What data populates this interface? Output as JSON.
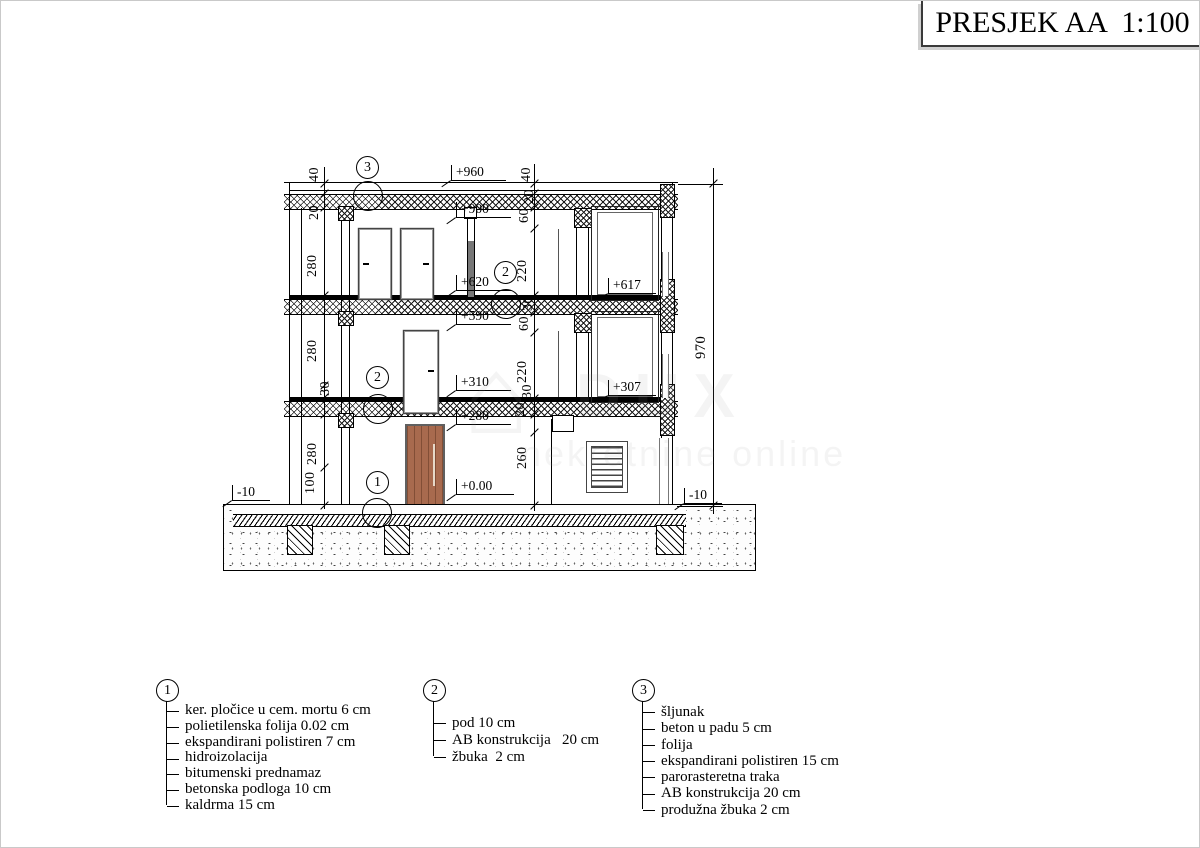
{
  "title": "PRESJEK AA  1:100",
  "watermark": {
    "house_glyph": "⌂",
    "brand": "DUX",
    "sub": "nekretnine online"
  },
  "dims": {
    "left": [
      "40",
      "20",
      "280",
      "280",
      "30",
      "280",
      "100"
    ],
    "center": [
      "40",
      "20",
      "60",
      "220",
      "30",
      "60",
      "220",
      "30",
      "20",
      "260"
    ],
    "overall": "970"
  },
  "elevations": [
    "+960",
    "+900",
    "+620",
    "+590",
    "+310",
    "+280",
    "+0.00",
    "+617",
    "+307",
    "-10",
    "-10"
  ],
  "callouts": [
    "3",
    "2",
    "2",
    "1"
  ],
  "legends": [
    {
      "num": "1",
      "items": [
        "ker. pločice u cem. mortu 6 cm",
        "polietilenska folija 0.02 cm",
        "ekspandirani polistiren 7 cm",
        "hidroizolacija",
        "bitumenski prednamaz",
        "betonska podloga 10 cm",
        "kaldrma 15 cm"
      ]
    },
    {
      "num": "2",
      "items": [
        "pod 10 cm",
        "AB konstrukcija   20 cm",
        "žbuka  2 cm"
      ]
    },
    {
      "num": "3",
      "items": [
        "šljunak",
        "beton u padu 5 cm",
        "folija",
        "ekspandirani polistiren 15 cm",
        "parorasteretna traka",
        "AB konstrukcija 20 cm",
        "produžna žbuka 2 cm"
      ]
    }
  ]
}
